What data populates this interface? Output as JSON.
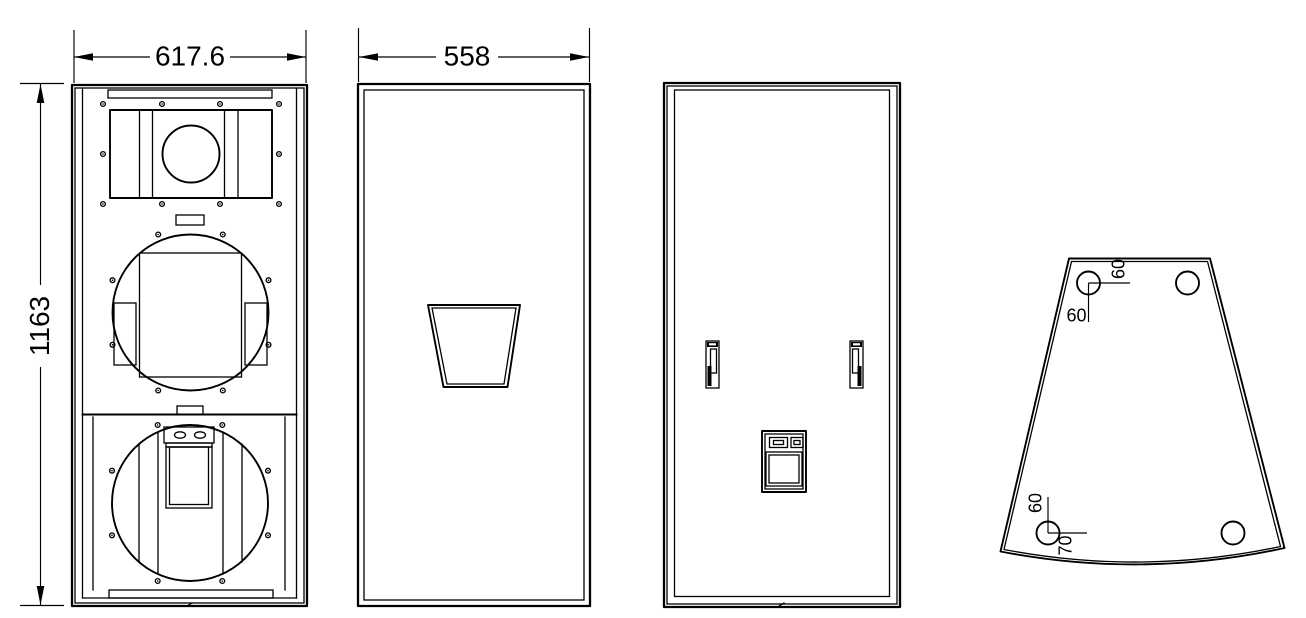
{
  "page": {
    "background": "#ffffff",
    "ink": "#000000"
  },
  "drawing": {
    "front_view": {
      "width_dim": "617.6",
      "height_dim": "1163"
    },
    "side_view": {
      "width_dim": "558"
    },
    "plan_view": {
      "top_hole_offset_x": "60",
      "top_hole_offset_y": "60",
      "bottom_hole_offset_y": "60",
      "bottom_hole_offset_x": "70"
    }
  }
}
